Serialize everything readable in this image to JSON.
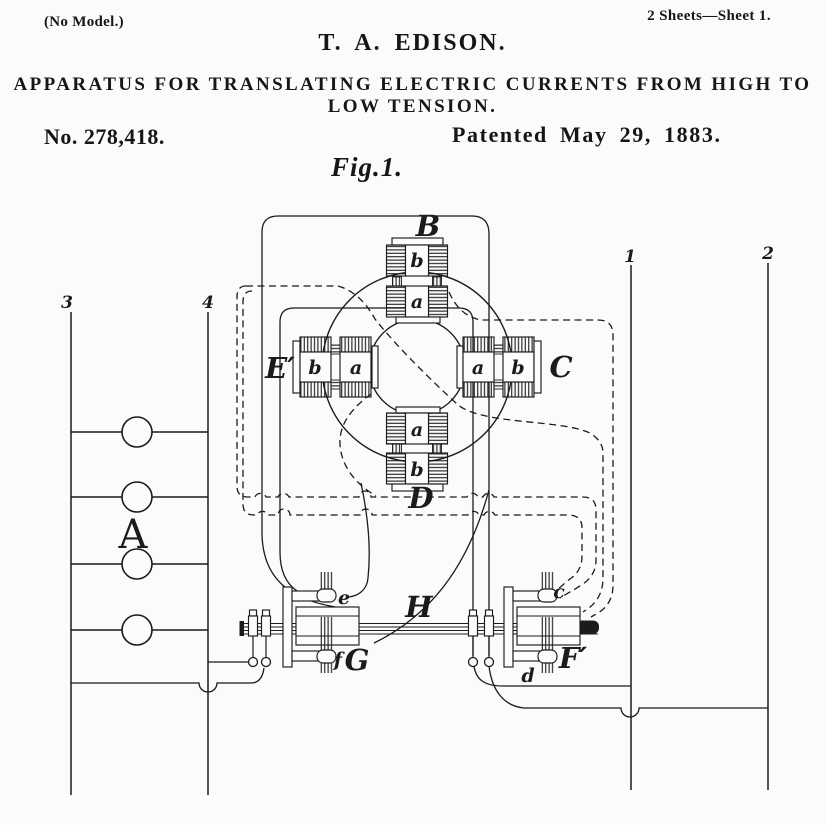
{
  "colors": {
    "ink": "#1b1b1b",
    "paper": "#fcfcfa"
  },
  "header": {
    "no_model": "(No Model.)",
    "sheets": "2 Sheets—Sheet 1.",
    "inventor": "T. A. EDISON.",
    "title_line1": "APPARATUS FOR TRANSLATING ELECTRIC CURRENTS FROM HIGH TO",
    "title_line2": "LOW TENSION.",
    "patent_number": "No. 278,418.",
    "patent_date": "Patented May 29, 1883.",
    "figure_label": "Fig.1."
  },
  "figure": {
    "labels": [
      {
        "text": "B",
        "x": 428,
        "y": 236,
        "cls": "lab-big"
      },
      {
        "text": "C",
        "x": 561,
        "y": 377,
        "cls": "lab-big"
      },
      {
        "text": "D",
        "x": 421,
        "y": 508,
        "cls": "lab-big"
      },
      {
        "text": "E′",
        "x": 280,
        "y": 378,
        "cls": "lab-big"
      },
      {
        "text": "F′",
        "x": 573,
        "y": 668,
        "cls": "lab-big"
      },
      {
        "text": "G",
        "x": 357,
        "y": 670,
        "cls": "lab-big"
      },
      {
        "text": "H",
        "x": 419,
        "y": 617,
        "cls": "lab-big"
      },
      {
        "text": "A",
        "x": 133,
        "y": 548,
        "cls": "lab-serif"
      },
      {
        "text": "b",
        "x": 417,
        "y": 267,
        "cls": "lab-small"
      },
      {
        "text": "a",
        "x": 417,
        "y": 308,
        "cls": "lab-small"
      },
      {
        "text": "a",
        "x": 417,
        "y": 436,
        "cls": "lab-small"
      },
      {
        "text": "b",
        "x": 417,
        "y": 476,
        "cls": "lab-small"
      },
      {
        "text": "b",
        "x": 315,
        "y": 374,
        "cls": "lab-small"
      },
      {
        "text": "a",
        "x": 356,
        "y": 374,
        "cls": "lab-small"
      },
      {
        "text": "a",
        "x": 478,
        "y": 374,
        "cls": "lab-small"
      },
      {
        "text": "b",
        "x": 518,
        "y": 374,
        "cls": "lab-small"
      },
      {
        "text": "e",
        "x": 344,
        "y": 604,
        "cls": "lab-small"
      },
      {
        "text": "f",
        "x": 338,
        "y": 666,
        "cls": "lab-small"
      },
      {
        "text": "c",
        "x": 559,
        "y": 598,
        "cls": "lab-small"
      },
      {
        "text": "d",
        "x": 528,
        "y": 682,
        "cls": "lab-small"
      },
      {
        "text": "3",
        "x": 67,
        "y": 308,
        "cls": "lab-num"
      },
      {
        "text": "4",
        "x": 208,
        "y": 308,
        "cls": "lab-num"
      },
      {
        "text": "1",
        "x": 630,
        "y": 262,
        "cls": "lab-num"
      },
      {
        "text": "2",
        "x": 768,
        "y": 259,
        "cls": "lab-num"
      }
    ]
  }
}
